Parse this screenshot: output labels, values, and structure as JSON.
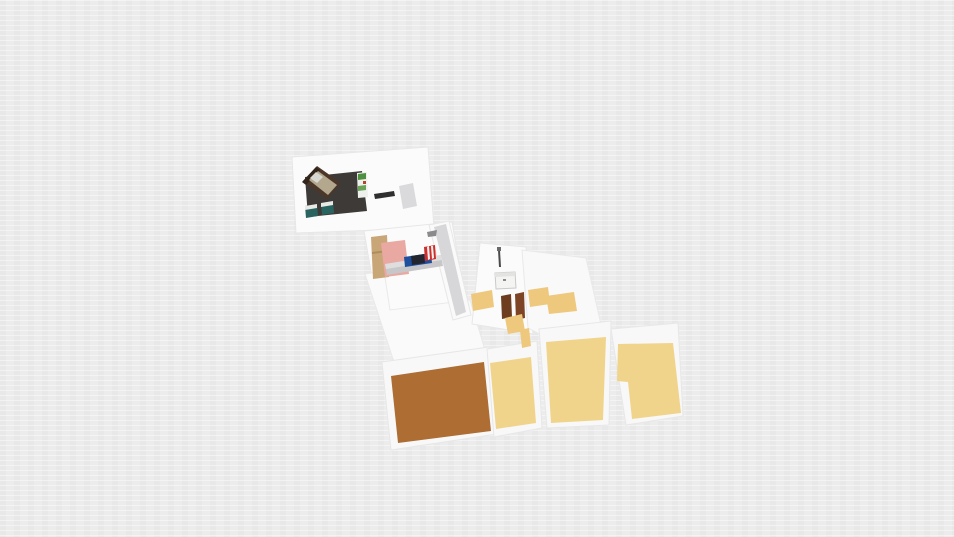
{
  "app": {
    "name": "3d-floorplan-render",
    "description": "Isometric 3D render of an apartment floor plan on an empty light-gray canvas; no visible UI chrome or text"
  },
  "canvas": {
    "width": 954,
    "height": 537,
    "background": "#ececec"
  },
  "palette": {
    "canvas_gray": "#ececec",
    "wall_white": "#fbfbfb",
    "wall_mat": "#f8f8f9",
    "wall_edge": "#e4e4e6",
    "corridor_gray": "#d7d7d9",
    "dark_room_floor": "#3d3a37",
    "brown_floor": "#ad6d33",
    "tan_floor": "#f1d48b",
    "tan_patch": "#eec87d",
    "pink_rug": "#e9a8a2",
    "wardrobe_wood": "#c9a678",
    "door_brown": "#6e3d20",
    "bed_frame": "#4a3729",
    "desk_teal": "#2a6460",
    "shelf_green": "#4d9040",
    "item_blue": "#1d4f9e",
    "item_red": "#cf2f2a"
  },
  "scene": {
    "elements": [
      {
        "name": "wall-plate-top-bedroom",
        "fill": "#fbfbfb",
        "stroke": "#e7e7e8",
        "points": [
          [
            292,
            157
          ],
          [
            428,
            147
          ],
          [
            434,
            228
          ],
          [
            296,
            233
          ]
        ]
      },
      {
        "name": "wall-plate-middle-bedroom",
        "fill": "#fbfbfb",
        "stroke": "#e7e7e8",
        "points": [
          [
            364,
            231
          ],
          [
            452,
            222
          ],
          [
            467,
            310
          ],
          [
            379,
            318
          ]
        ]
      },
      {
        "name": "wall-plate-left-wing",
        "fill": "#fafafb",
        "stroke": "#e9e9ea",
        "points": [
          [
            365,
            274
          ],
          [
            384,
            271
          ],
          [
            390,
            310
          ],
          [
            470,
            300
          ],
          [
            488,
            360
          ],
          [
            396,
            368
          ]
        ]
      },
      {
        "name": "wall-plate-corridor",
        "fill": "#fafafa",
        "stroke": "#e7e7e8",
        "points": [
          [
            429,
            225
          ],
          [
            449,
            221
          ],
          [
            471,
            315
          ],
          [
            453,
            320
          ]
        ]
      },
      {
        "name": "corridor-floor",
        "fill": "#d7d7d9",
        "points": [
          [
            434,
            227
          ],
          [
            446,
            224
          ],
          [
            466,
            312
          ],
          [
            456,
            316
          ]
        ]
      },
      {
        "name": "wall-plate-bathroom",
        "fill": "#fbfbfb",
        "stroke": "#e7e7e8",
        "points": [
          [
            480,
            243
          ],
          [
            526,
            247
          ],
          [
            533,
            334
          ],
          [
            472,
            324
          ]
        ]
      },
      {
        "name": "wall-plate-right-mid",
        "fill": "#f9f9fa",
        "stroke": "#e9e9ea",
        "points": [
          [
            522,
            250
          ],
          [
            586,
            258
          ],
          [
            604,
            338
          ],
          [
            558,
            344
          ],
          [
            528,
            328
          ]
        ]
      },
      {
        "name": "wall-mat-brown-room",
        "fill": "#f8f8f9",
        "stroke": "#e7e7e8",
        "points": [
          [
            382,
            362
          ],
          [
            489,
            347
          ],
          [
            497,
            434
          ],
          [
            391,
            450
          ]
        ]
      },
      {
        "name": "wall-mat-tan-room-a",
        "fill": "#f8f8f9",
        "stroke": "#e7e7e8",
        "points": [
          [
            487,
            349
          ],
          [
            537,
            341
          ],
          [
            542,
            428
          ],
          [
            494,
            437
          ]
        ]
      },
      {
        "name": "wall-mat-tan-room-b",
        "fill": "#f8f8f9",
        "stroke": "#e7e7e8",
        "points": [
          [
            539,
            329
          ],
          [
            611,
            321
          ],
          [
            609,
            425
          ],
          [
            547,
            428
          ]
        ]
      },
      {
        "name": "wall-mat-tan-room-c",
        "fill": "#f8f8f9",
        "stroke": "#e7e7e8",
        "points": [
          [
            611,
            329
          ],
          [
            678,
            323
          ],
          [
            683,
            416
          ],
          [
            626,
            425
          ]
        ]
      },
      {
        "name": "floor-brown-room",
        "fill": "#ad6d33",
        "points": [
          [
            391,
            376
          ],
          [
            484,
            362
          ],
          [
            491,
            431
          ],
          [
            398,
            443
          ]
        ]
      },
      {
        "name": "floor-tan-room-a",
        "fill": "#f1d48b",
        "points": [
          [
            490,
            363
          ],
          [
            531,
            357
          ],
          [
            536,
            423
          ],
          [
            496,
            429
          ]
        ]
      },
      {
        "name": "floor-tan-room-b",
        "fill": "#f1d48b",
        "points": [
          [
            546,
            342
          ],
          [
            606,
            337
          ],
          [
            603,
            420
          ],
          [
            551,
            423
          ]
        ]
      },
      {
        "name": "floor-tan-room-c",
        "fill": "#f1d48b",
        "points": [
          [
            618,
            344
          ],
          [
            673,
            343
          ],
          [
            681,
            413
          ],
          [
            632,
            419
          ],
          [
            628,
            382
          ],
          [
            617,
            381
          ]
        ]
      },
      {
        "name": "dark-bedroom-floor",
        "fill": "#3d3a37",
        "points": [
          [
            305,
            177
          ],
          [
            362,
            171
          ],
          [
            367,
            211
          ],
          [
            308,
            217
          ]
        ]
      },
      {
        "name": "bed-frame",
        "fill": "#4a3729",
        "points": [
          [
            303,
            181
          ],
          [
            317,
            166
          ],
          [
            341,
            183
          ],
          [
            327,
            199
          ]
        ]
      },
      {
        "name": "bed-headboard",
        "fill": "#32251a",
        "points": [
          [
            302,
            182
          ],
          [
            316,
            167
          ],
          [
            320,
            170
          ],
          [
            306,
            185
          ]
        ]
      },
      {
        "name": "bed-mattress",
        "fill": "#b3a78d",
        "points": [
          [
            309,
            180
          ],
          [
            318,
            171
          ],
          [
            337,
            185
          ],
          [
            328,
            195
          ]
        ]
      },
      {
        "name": "bed-pillow",
        "fill": "#d8d8d2",
        "points": [
          [
            310,
            178
          ],
          [
            316,
            172
          ],
          [
            323,
            177
          ],
          [
            317,
            183
          ]
        ]
      },
      {
        "name": "desk-1-body",
        "fill": "#2a6460",
        "points": [
          [
            305,
            206
          ],
          [
            317,
            204
          ],
          [
            318,
            216
          ],
          [
            306,
            218
          ]
        ]
      },
      {
        "name": "desk-1-top",
        "fill": "#e9e9e5",
        "points": [
          [
            305,
            206
          ],
          [
            317,
            204
          ],
          [
            317,
            208
          ],
          [
            305,
            210
          ]
        ]
      },
      {
        "name": "desk-2-body",
        "fill": "#2a6460",
        "points": [
          [
            321,
            203
          ],
          [
            333,
            201
          ],
          [
            334,
            213
          ],
          [
            322,
            215
          ]
        ]
      },
      {
        "name": "desk-2-top",
        "fill": "#e9e9e5",
        "points": [
          [
            321,
            203
          ],
          [
            333,
            201
          ],
          [
            333,
            205
          ],
          [
            321,
            207
          ]
        ]
      },
      {
        "name": "shelf-unit",
        "fill": "#eef0ee",
        "points": [
          [
            357,
            173
          ],
          [
            367,
            172
          ],
          [
            368,
            197
          ],
          [
            358,
            198
          ]
        ]
      },
      {
        "name": "shelf-plant-top",
        "fill": "#4d9040",
        "points": [
          [
            358,
            174
          ],
          [
            366,
            173
          ],
          [
            366,
            179
          ],
          [
            358,
            180
          ]
        ]
      },
      {
        "name": "shelf-red-item",
        "fill": "#b5452f",
        "points": [
          [
            363,
            181
          ],
          [
            366,
            181
          ],
          [
            366,
            184
          ],
          [
            363,
            184
          ]
        ]
      },
      {
        "name": "shelf-plant-mid",
        "fill": "#6aa357",
        "points": [
          [
            358,
            186
          ],
          [
            366,
            185
          ],
          [
            366,
            190
          ],
          [
            358,
            191
          ]
        ]
      },
      {
        "name": "tv-console-bar",
        "fill": "#2f2f2f",
        "points": [
          [
            374,
            194
          ],
          [
            394,
            191
          ],
          [
            395,
            196
          ],
          [
            375,
            199
          ]
        ]
      },
      {
        "name": "gray-area-rug",
        "fill": "#dadadc",
        "points": [
          [
            399,
            186
          ],
          [
            413,
            183
          ],
          [
            417,
            206
          ],
          [
            403,
            209
          ]
        ]
      },
      {
        "name": "wardrobe",
        "fill": "#c9a678",
        "points": [
          [
            371,
            237
          ],
          [
            387,
            235
          ],
          [
            389,
            277
          ],
          [
            373,
            279
          ]
        ]
      },
      {
        "name": "wardrobe-shelf-line",
        "fill": "#b08d5c",
        "points": [
          [
            372,
            252
          ],
          [
            388,
            250
          ],
          [
            388,
            252
          ],
          [
            372,
            254
          ]
        ]
      },
      {
        "name": "pink-bedroom-rug",
        "fill": "#e9a8a2",
        "points": [
          [
            381,
            243
          ],
          [
            405,
            240
          ],
          [
            409,
            274
          ],
          [
            385,
            277
          ]
        ]
      },
      {
        "name": "low-platform",
        "fill": "#c7c7c9",
        "points": [
          [
            385,
            264
          ],
          [
            441,
            255
          ],
          [
            443,
            266
          ],
          [
            387,
            275
          ]
        ]
      },
      {
        "name": "low-platform-top",
        "fill": "#dededf",
        "points": [
          [
            385,
            264
          ],
          [
            441,
            255
          ],
          [
            442,
            260
          ],
          [
            386,
            269
          ]
        ]
      },
      {
        "name": "blue-storage-box",
        "fill": "#1d4f9e",
        "points": [
          [
            404,
            257
          ],
          [
            431,
            253
          ],
          [
            432,
            263
          ],
          [
            405,
            267
          ]
        ]
      },
      {
        "name": "blue-box-dark-section",
        "fill": "#23262e",
        "points": [
          [
            411,
            256
          ],
          [
            424,
            254
          ],
          [
            425,
            263
          ],
          [
            412,
            265
          ]
        ]
      },
      {
        "name": "red-chair",
        "fill": "#cf2f2a",
        "points": [
          [
            424,
            247
          ],
          [
            435,
            245
          ],
          [
            436,
            259
          ],
          [
            425,
            261
          ]
        ]
      },
      {
        "name": "red-chair-stripe-1",
        "fill": "#f2f2f2",
        "points": [
          [
            427,
            247
          ],
          [
            429,
            246
          ],
          [
            430,
            259
          ],
          [
            428,
            260
          ]
        ]
      },
      {
        "name": "red-chair-stripe-2",
        "fill": "#f2f2f2",
        "points": [
          [
            431,
            246
          ],
          [
            433,
            246
          ],
          [
            434,
            258
          ],
          [
            432,
            259
          ]
        ]
      },
      {
        "name": "corridor-wall-mark",
        "fill": "#8a8a8c",
        "points": [
          [
            427,
            232
          ],
          [
            437,
            230
          ],
          [
            436,
            236
          ],
          [
            428,
            237
          ]
        ]
      },
      {
        "name": "floor-lamp-pole",
        "fill": "#4a4a4a",
        "points": [
          [
            498,
            250
          ],
          [
            500,
            250
          ],
          [
            501,
            267
          ],
          [
            499,
            267
          ]
        ]
      },
      {
        "name": "floor-lamp-head",
        "fill": "#6a6a6a",
        "points": [
          [
            497,
            247
          ],
          [
            501,
            247
          ],
          [
            501,
            251
          ],
          [
            497,
            251
          ]
        ]
      },
      {
        "name": "sink-cabinet",
        "fill": "#f4f4f3",
        "stroke": "#c9c9c9",
        "points": [
          [
            495,
            273
          ],
          [
            515,
            272
          ],
          [
            516,
            288
          ],
          [
            496,
            289
          ]
        ]
      },
      {
        "name": "sink-top-face",
        "fill": "#e3e3e2",
        "points": [
          [
            495,
            273
          ],
          [
            515,
            272
          ],
          [
            515,
            276
          ],
          [
            495,
            277
          ]
        ]
      },
      {
        "name": "sink-handle",
        "fill": "#8a8a8a",
        "points": [
          [
            503,
            279
          ],
          [
            506,
            279
          ],
          [
            506,
            281
          ],
          [
            503,
            281
          ]
        ]
      },
      {
        "name": "door-panel-left",
        "fill": "#6e3d20",
        "points": [
          [
            501,
            296
          ],
          [
            511,
            294
          ],
          [
            512,
            317
          ],
          [
            502,
            319
          ]
        ]
      },
      {
        "name": "door-panel-right",
        "fill": "#7d4526",
        "points": [
          [
            515,
            294
          ],
          [
            524,
            292
          ],
          [
            525,
            318
          ],
          [
            516,
            320
          ]
        ]
      },
      {
        "name": "tan-threshold-below-door",
        "fill": "#eec87d",
        "points": [
          [
            505,
            318
          ],
          [
            522,
            314
          ],
          [
            525,
            331
          ],
          [
            508,
            334
          ]
        ]
      },
      {
        "name": "tan-patch-left",
        "fill": "#eec87d",
        "points": [
          [
            471,
            294
          ],
          [
            492,
            290
          ],
          [
            494,
            307
          ],
          [
            473,
            311
          ]
        ]
      },
      {
        "name": "tan-patch-mid-1",
        "fill": "#eec87d",
        "points": [
          [
            528,
            290
          ],
          [
            548,
            287
          ],
          [
            550,
            304
          ],
          [
            530,
            307
          ]
        ]
      },
      {
        "name": "tan-patch-mid-2",
        "fill": "#eec87d",
        "points": [
          [
            546,
            296
          ],
          [
            574,
            292
          ],
          [
            577,
            311
          ],
          [
            549,
            314
          ]
        ]
      },
      {
        "name": "tan-patch-sliver",
        "fill": "#eec87d",
        "points": [
          [
            520,
            330
          ],
          [
            529,
            328
          ],
          [
            531,
            346
          ],
          [
            522,
            348
          ]
        ]
      }
    ]
  }
}
